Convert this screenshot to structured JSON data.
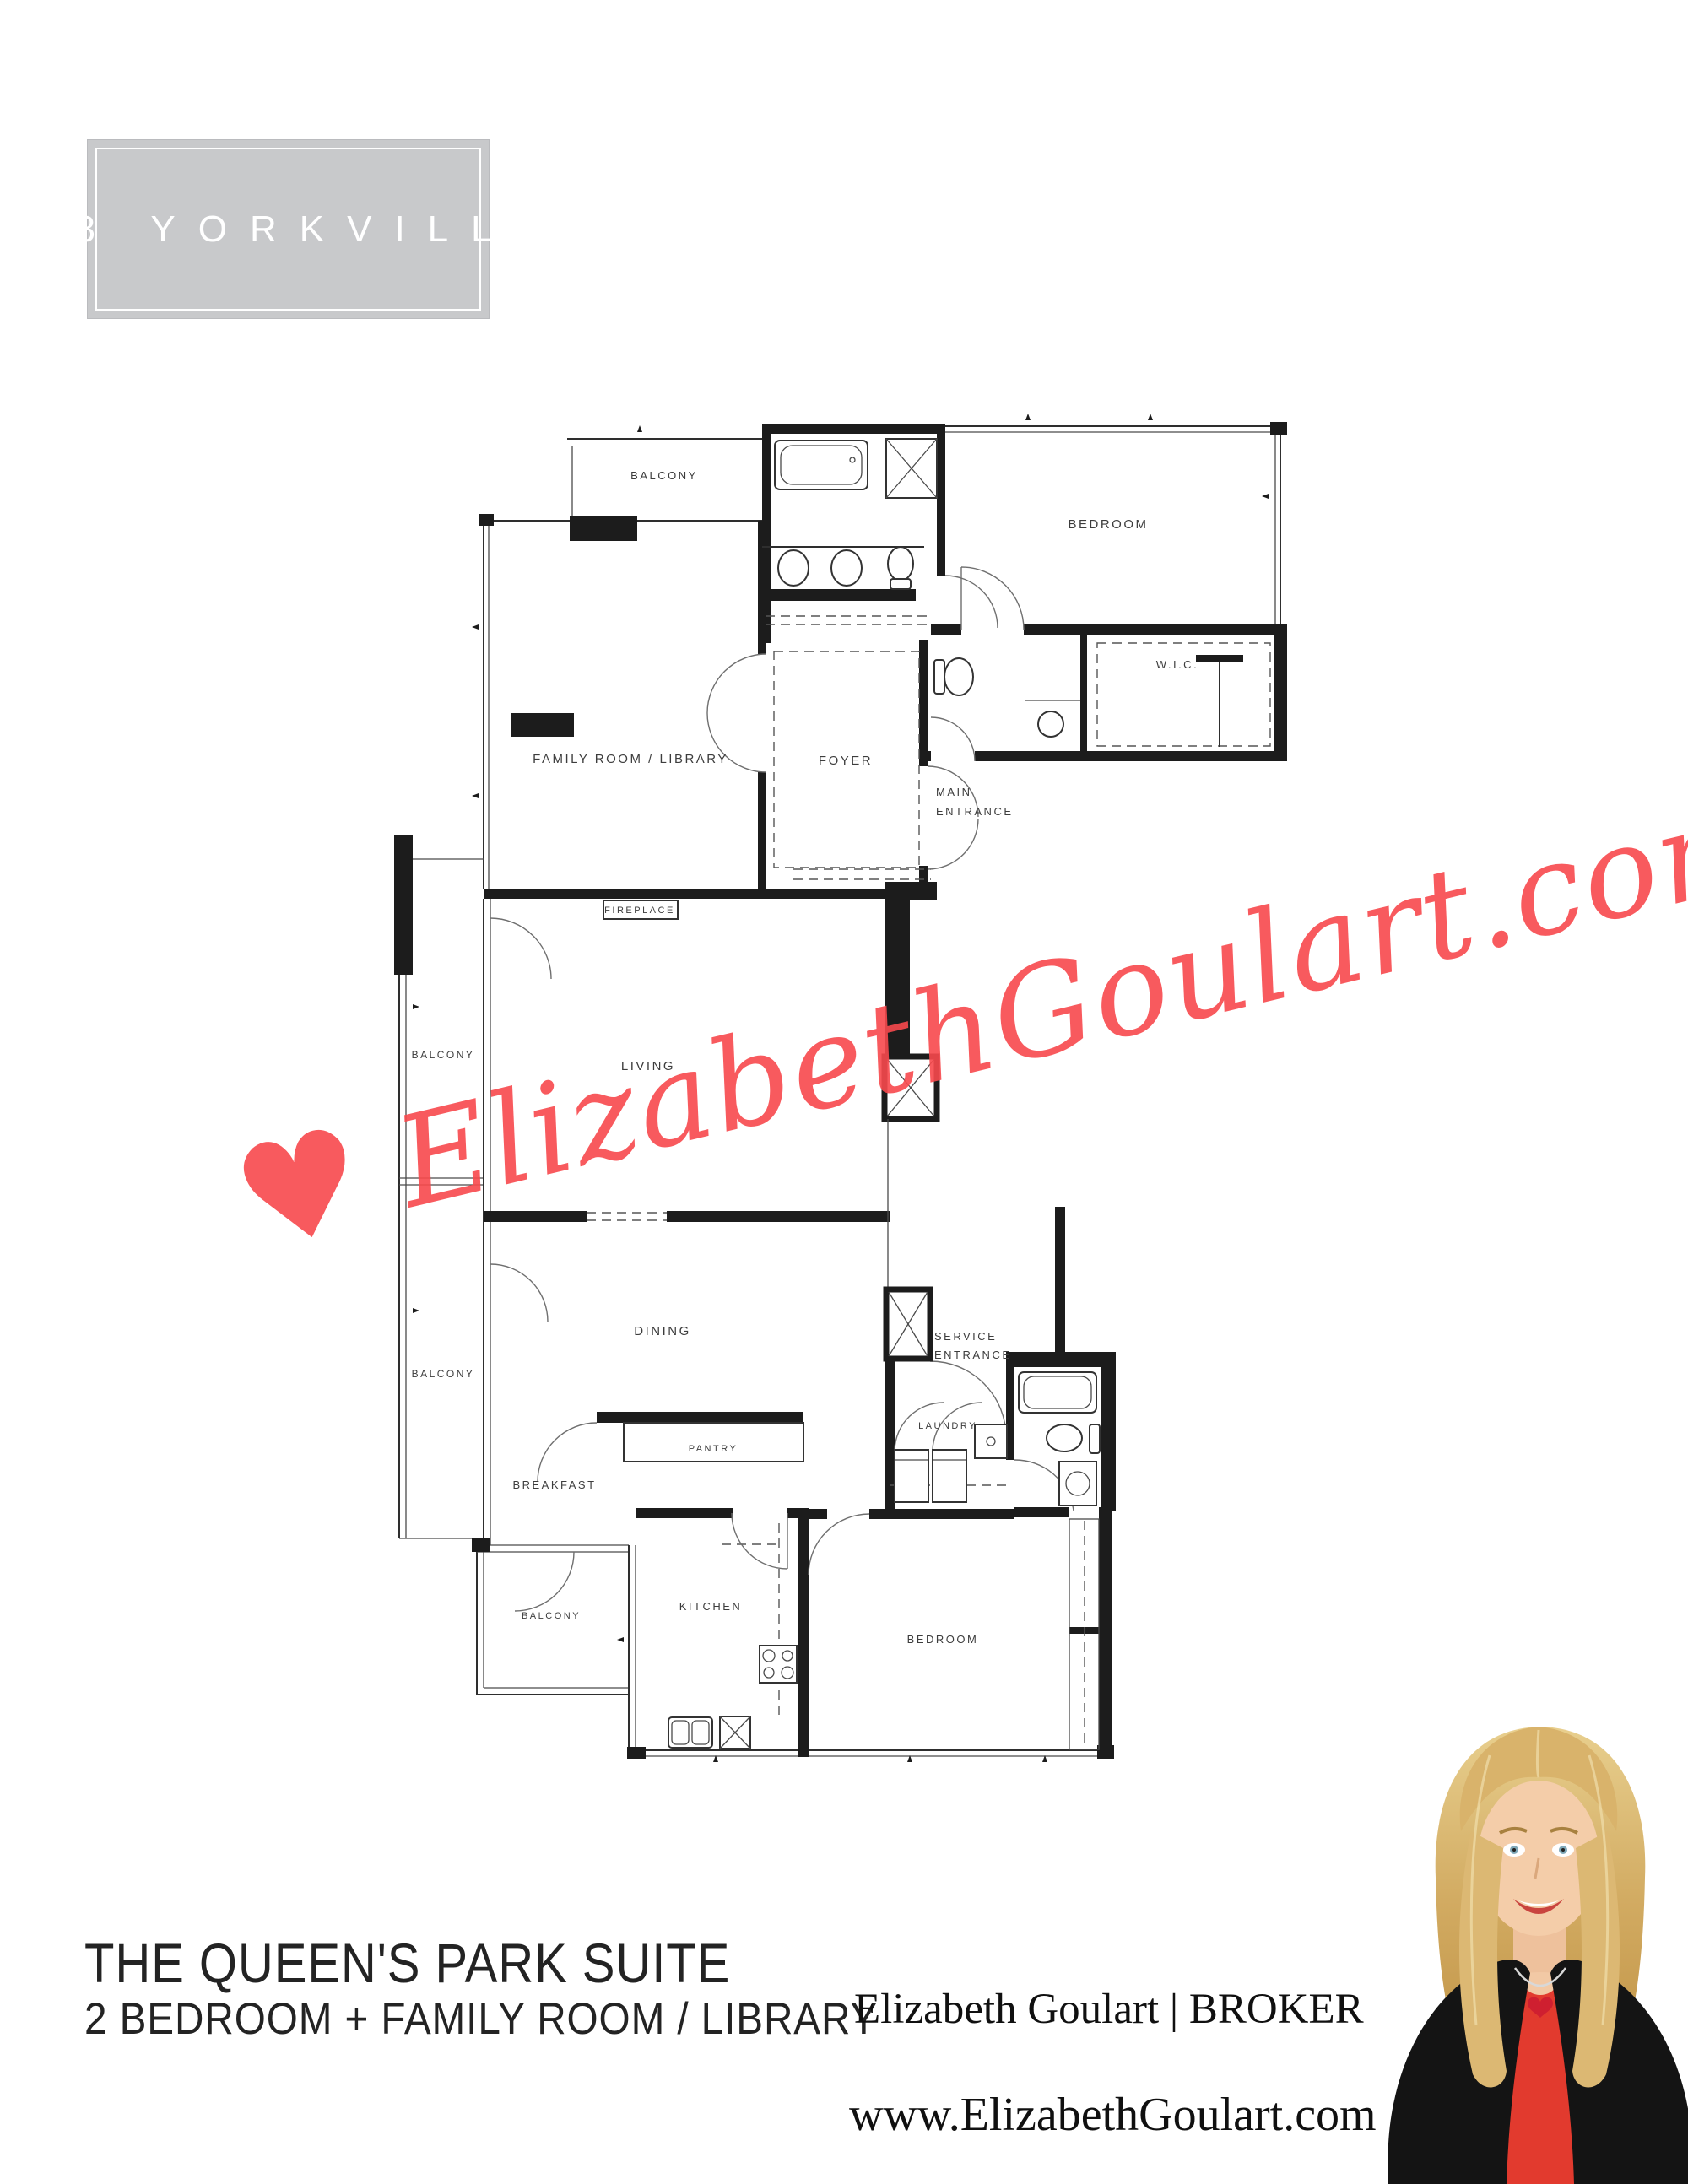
{
  "page": {
    "background": "#ffffff"
  },
  "header_box": {
    "title": "18 YORKVILLE",
    "bg": "#c8c9cb",
    "text_color": "#ffffff"
  },
  "watermark": {
    "heart_icon": "♥",
    "text": "ElizabethGoulart.com",
    "color": "#f8494d"
  },
  "floorplan": {
    "line_color": "#1c1c1c",
    "label_color": "#3d3d3d",
    "rooms": {
      "balcony_top": "BALCONY",
      "bedroom_top": "BEDROOM",
      "wic": "W.I.C.",
      "family_room": "FAMILY ROOM / LIBRARY",
      "foyer": "FOYER",
      "main_entrance_1": "MAIN",
      "main_entrance_2": "ENTRANCE",
      "fireplace": "FIREPLACE",
      "living": "LIVING",
      "balcony_mid": "BALCONY",
      "balcony_low": "BALCONY",
      "dining": "DINING",
      "service_entrance_1": "SERVICE",
      "service_entrance_2": "ENTRANCE",
      "laundry": "LAUNDRY",
      "pantry": "PANTRY",
      "breakfast": "BREAKFAST",
      "balcony_bottom": "BALCONY",
      "kitchen": "KITCHEN",
      "bedroom_bottom": "BEDROOM"
    }
  },
  "footer": {
    "suite_name": "THE QUEEN'S PARK SUITE",
    "suite_desc": "2 BEDROOM + FAMILY ROOM / LIBRARY",
    "broker": "Elizabeth Goulart | BROKER",
    "website": "www.ElizabethGoulart.com"
  }
}
